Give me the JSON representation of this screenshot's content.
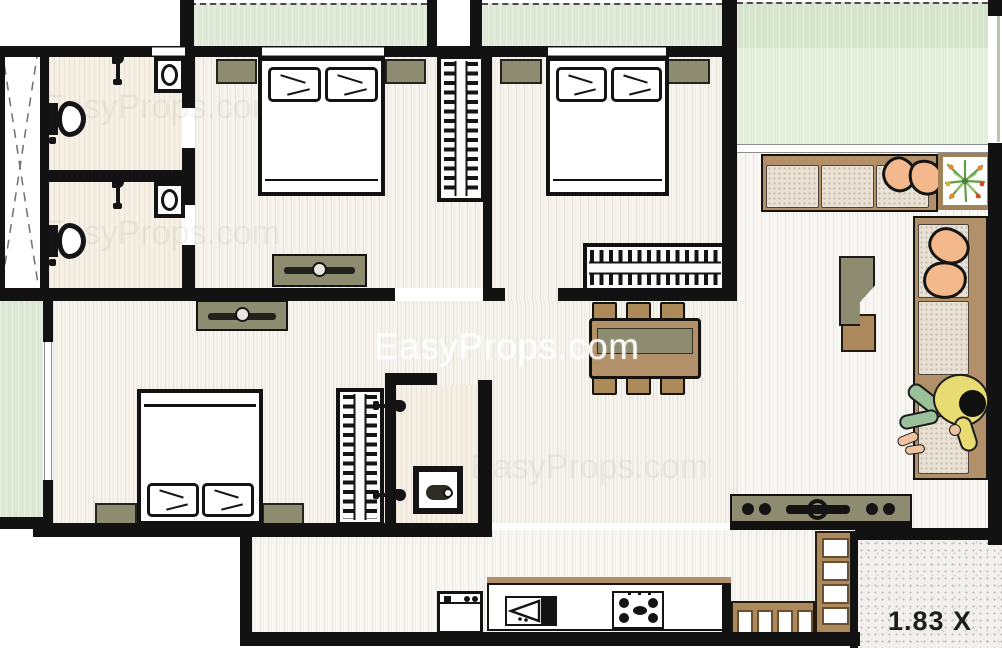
{
  "watermark": {
    "text": "EasyProps.com"
  },
  "scale_label": {
    "text": "1.83 X"
  },
  "palette": {
    "wall": "#121212",
    "wood_floor": "#f6f3ed",
    "bath_floor": "#f5efe4",
    "balcony_green": "#dde9d5",
    "terrace_green": "#e3eedb",
    "olive_furniture": "#8d8b70",
    "brown_furniture": "#b2916a",
    "cushion_beige": "#e9e1d3",
    "pillow_peach": "#f3b98c",
    "shirt_yellow": "#e7db72",
    "pants_green": "#9cc09a",
    "plant_green": "#6aa84f",
    "stipple_bg": "#f1f0ed"
  },
  "icons": {
    "toilet-icon": "css-shape",
    "shower-icon": "css-shape",
    "washbasin-icon": "css-shape",
    "stove-icon": "css-shape",
    "kitchen-sink-icon": "css-shape",
    "fridge-icon": "css-shape",
    "plant-icon": "svg-starburst",
    "person-figure": "css-shape",
    "duct-cross-icon": "svg-dashed-x"
  }
}
